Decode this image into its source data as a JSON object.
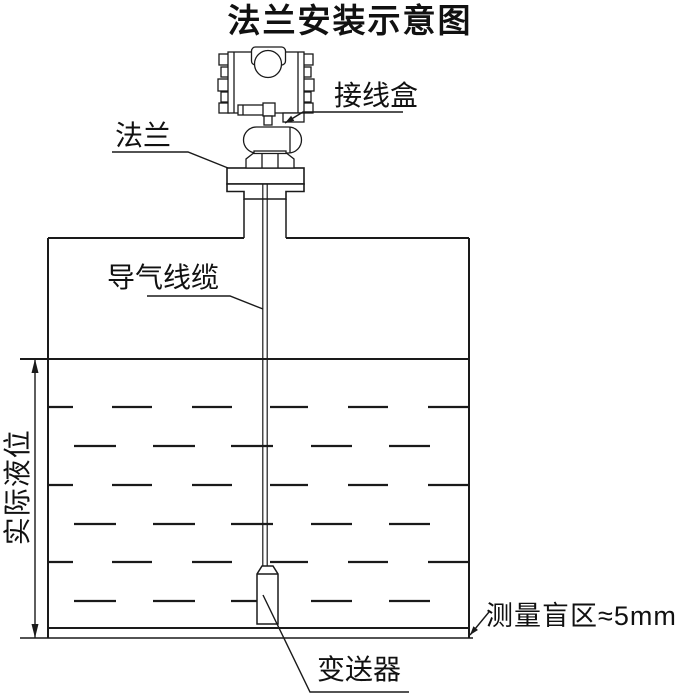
{
  "title": "法兰安装示意图",
  "labels": {
    "junction_box": "接线盒",
    "flange": "法兰",
    "air_cable": "导气线缆",
    "actual_level": "实际液位",
    "blind_zone": "测量盲区≈5mm",
    "transmitter": "变送器"
  },
  "colors": {
    "line": "#1a1a1a",
    "background": "#ffffff"
  }
}
